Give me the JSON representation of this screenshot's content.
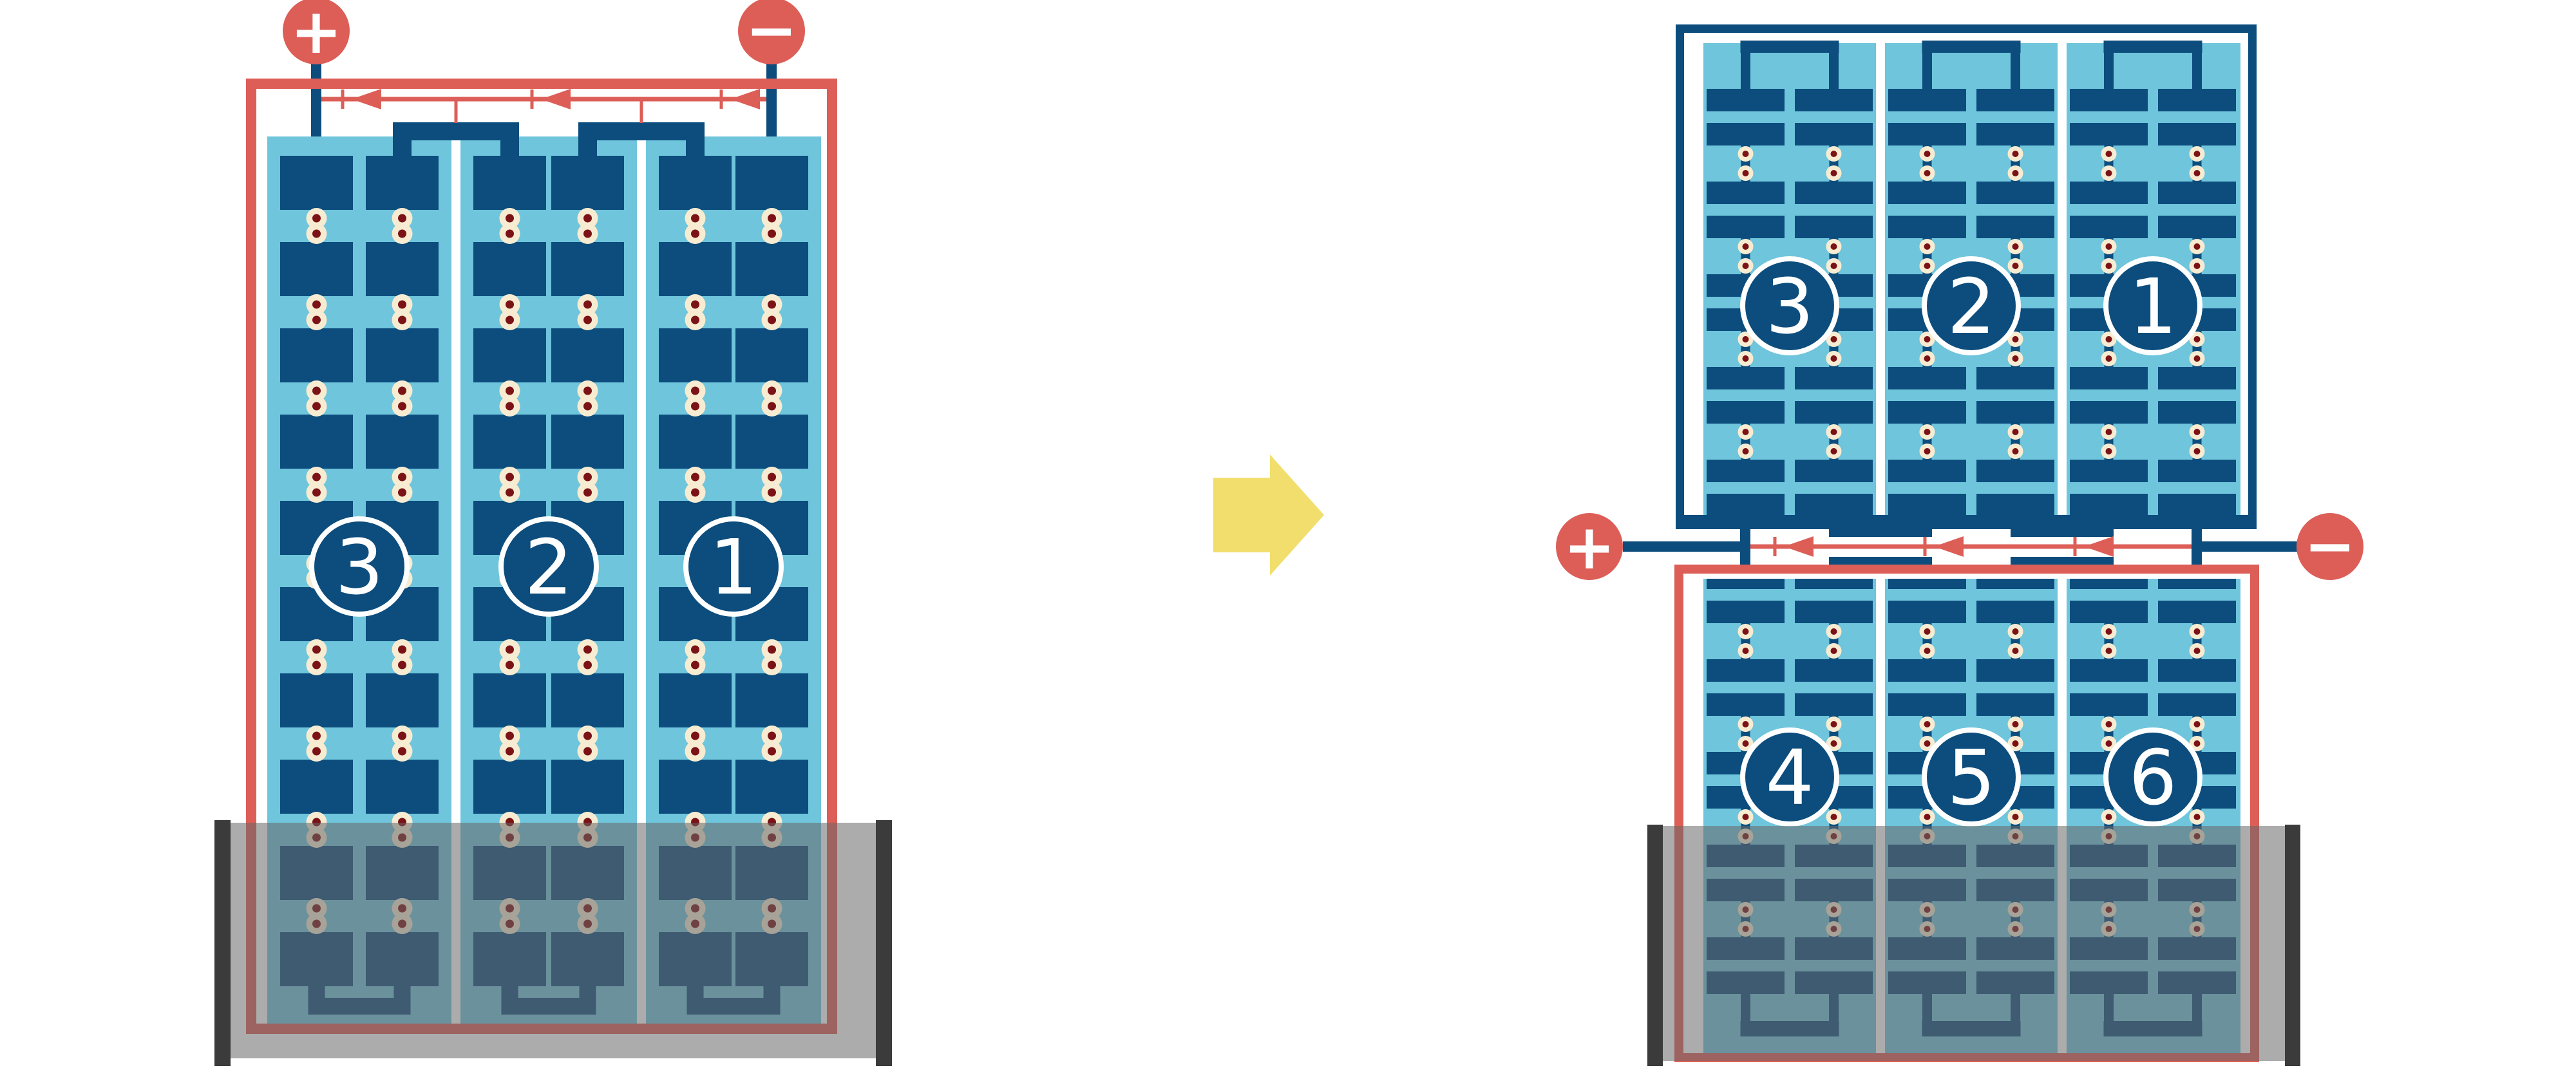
{
  "colors": {
    "red": "#DC5E57",
    "navy": "#0C4D7D",
    "light_blue": "#6FC5DC",
    "white": "#FFFFFF",
    "cream": "#F7ECD2",
    "rivet_red": "#7A1216",
    "tray_dark": "#3B3B3B",
    "tray_overlay": "rgba(104,104,104,0.55)",
    "arrow_yellow": "#F2DE6D"
  },
  "left_battery": {
    "plus_label": "+",
    "minus_label": "−",
    "cells": [
      {
        "label": "3"
      },
      {
        "label": "2"
      },
      {
        "label": "1"
      }
    ]
  },
  "right_battery": {
    "plus_label": "+",
    "minus_label": "−",
    "top_cells": [
      {
        "label": "3"
      },
      {
        "label": "2"
      },
      {
        "label": "1"
      }
    ],
    "bottom_cells": [
      {
        "label": "4"
      },
      {
        "label": "5"
      },
      {
        "label": "6"
      }
    ]
  }
}
